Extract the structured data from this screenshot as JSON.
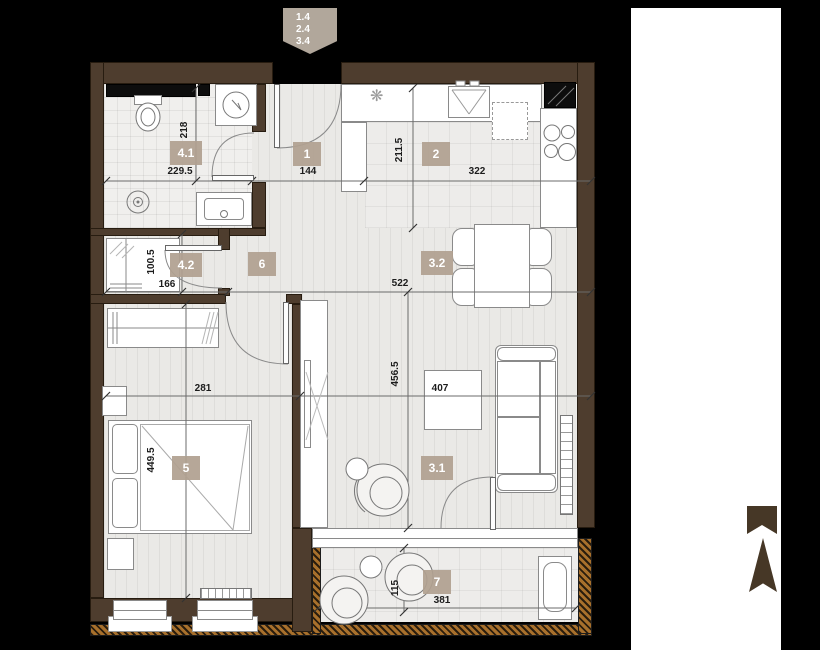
{
  "colors": {
    "background": "#000000",
    "wall": "#4e3d2e",
    "floor": "#eae9e6",
    "badge": "#b0a090",
    "hatch": "#a8702c",
    "accent_tag": "#b1a79b",
    "north": "#463726",
    "line": "#6b6b6b",
    "text": "#1c1c1c"
  },
  "level_tag": {
    "lines": [
      "1.4",
      "2.4",
      "3.4"
    ]
  },
  "rooms": {
    "hall": "1",
    "kitchen": "2",
    "living": "3.1",
    "dining": "3.2",
    "bathroom": "4.1",
    "closet": "4.2",
    "bedroom": "5",
    "corridor": "6",
    "balcony": "7"
  },
  "dimensions": {
    "bathroom_height": "218",
    "bathroom_width": "229.5",
    "hall_width": "144",
    "kitchen_height": "211.5",
    "kitchen_width": "322",
    "closet_height": "100.5",
    "closet_width": "166",
    "living_width": "522",
    "bedroom_width": "281",
    "living_height": "456.5",
    "living_width_inner": "407",
    "bedroom_height": "449.5",
    "balcony_height": "115",
    "balcony_width": "381"
  },
  "icons": {
    "vent": "❋"
  }
}
